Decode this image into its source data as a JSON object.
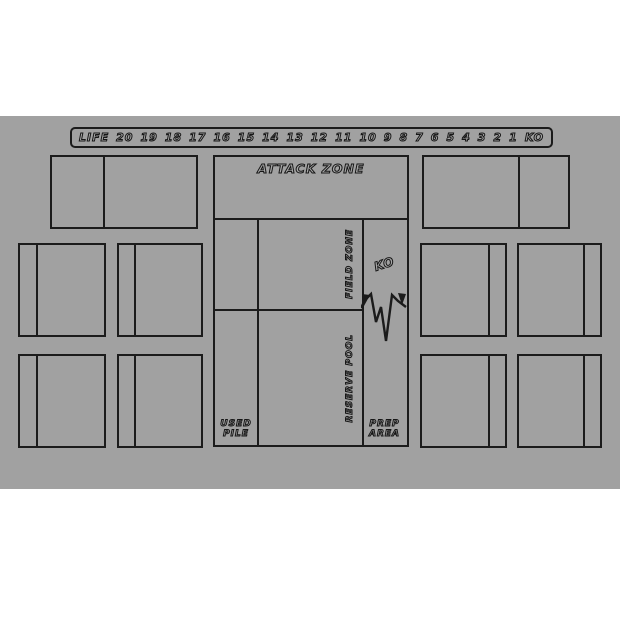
{
  "colors": {
    "mat_background": "#a1a1a1",
    "line": "#1b1b1b",
    "page_background": "#ffffff",
    "bubble_fill": "#a7a7a7"
  },
  "life_bar": {
    "label": "LIFE",
    "values": [
      "20",
      "19",
      "18",
      "17",
      "16",
      "15",
      "14",
      "13",
      "12",
      "11",
      "10",
      "9",
      "8",
      "7",
      "6",
      "5",
      "4",
      "3",
      "2",
      "1",
      "KO"
    ]
  },
  "zones": {
    "attack": "ATTACK ZONE",
    "field": "FIELD ZONE",
    "reserve": "RESERVE POOL",
    "ko": "KO",
    "used_pile": {
      "line1": "USED",
      "line2": "PILE"
    },
    "prep_area": {
      "line1": "PREP",
      "line2": "AREA"
    }
  }
}
